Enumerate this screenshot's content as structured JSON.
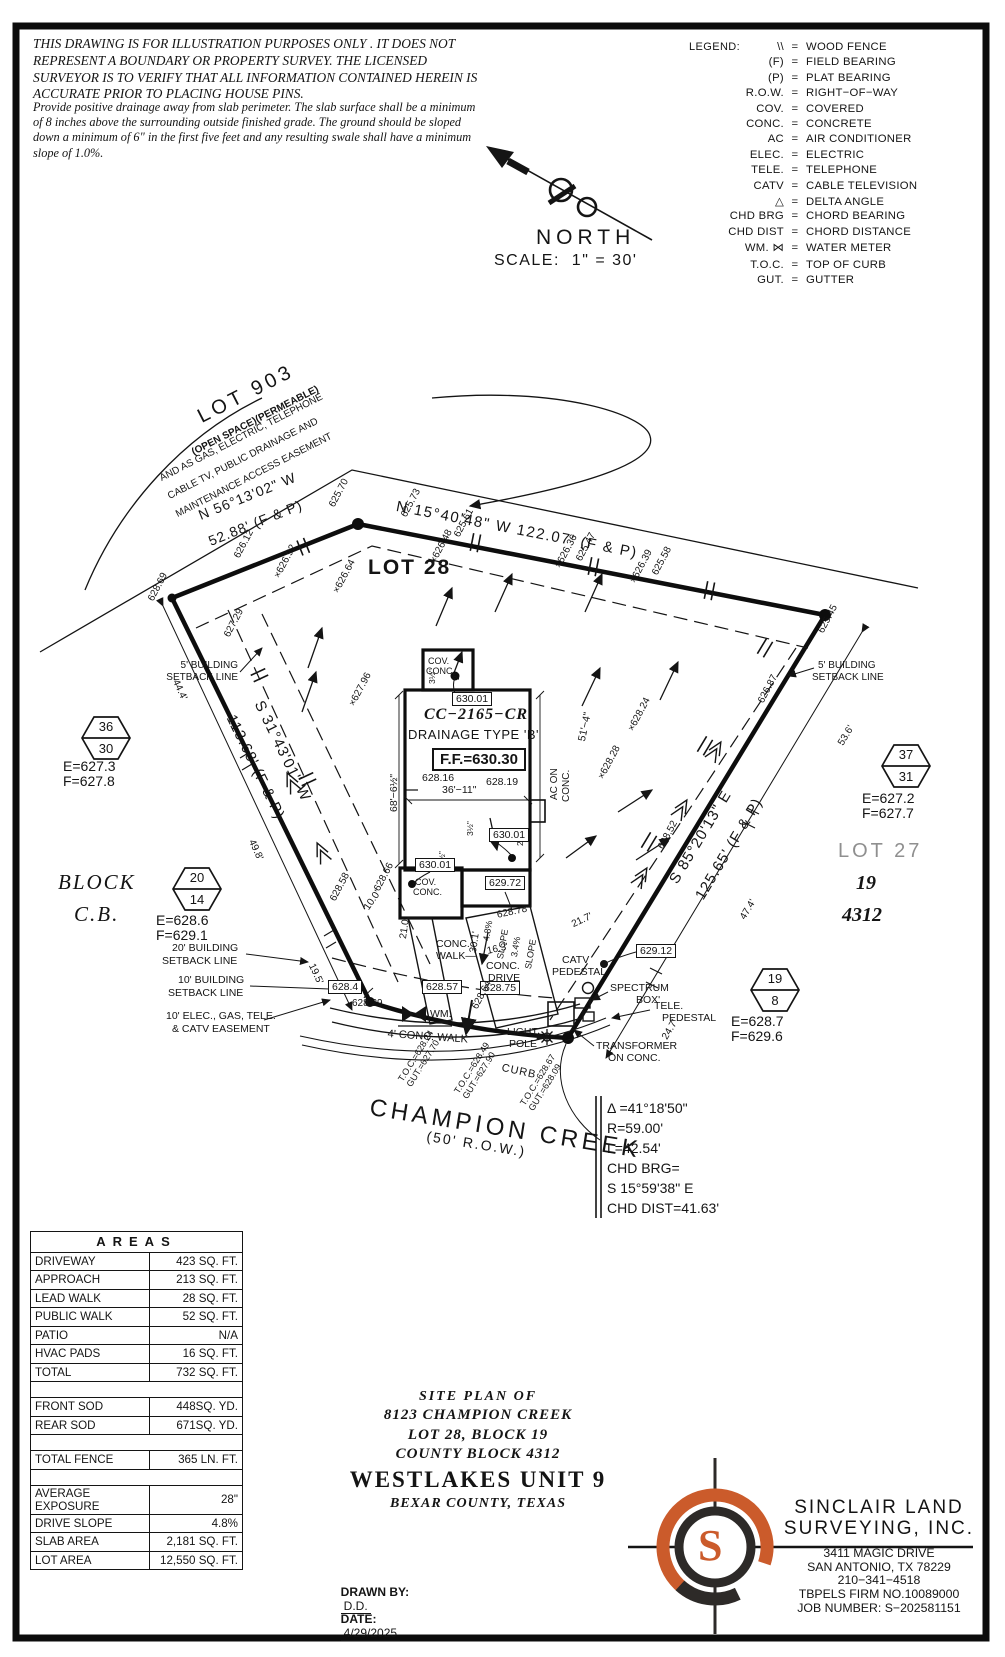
{
  "disclaimer": {
    "main": "THIS DRAWING IS FOR ILLUSTRATION PURPOSES ONLY . IT DOES NOT REPRESENT A BOUNDARY OR PROPERTY SURVEY. THE LICENSED SURVEYOR IS TO VERIFY THAT ALL INFORMATION CONTAINED HEREIN IS ACCURATE PRIOR TO PLACING HOUSE PINS.",
    "note": "Provide positive drainage away from slab perimeter. The slab surface shall be a minimum of 8 inches above the surrounding outside finished grade. The ground should be sloped down a minimum of 6\" in the first five feet and any resulting swale shall have a minimum slope of 1.0%."
  },
  "legend": {
    "title": "LEGEND:",
    "items": [
      {
        "sym": "\\\\",
        "def": "WOOD FENCE"
      },
      {
        "sym": "(F)",
        "def": "FIELD BEARING"
      },
      {
        "sym": "(P)",
        "def": "PLAT BEARING"
      },
      {
        "sym": "R.O.W.",
        "def": "RIGHT−OF−WAY"
      },
      {
        "sym": "COV.",
        "def": "COVERED"
      },
      {
        "sym": "CONC.",
        "def": "CONCRETE"
      },
      {
        "sym": "AC",
        "def": "AIR CONDITIONER"
      },
      {
        "sym": "ELEC.",
        "def": "ELECTRIC"
      },
      {
        "sym": "TELE.",
        "def": "TELEPHONE"
      },
      {
        "sym": "CATV",
        "def": "CABLE TELEVISION"
      },
      {
        "sym": "△",
        "def": "DELTA ANGLE"
      },
      {
        "sym": "CHD BRG",
        "def": "CHORD BEARING"
      },
      {
        "sym": "CHD DIST",
        "def": "CHORD DISTANCE"
      },
      {
        "sym": "WM. ⋈",
        "def": "WATER METER"
      },
      {
        "sym": "T.O.C.",
        "def": "TOP OF CURB"
      },
      {
        "sym": "GUT.",
        "def": "GUTTER"
      }
    ]
  },
  "compass": {
    "north": "NORTH",
    "scale": "SCALE:  1\" = 30'"
  },
  "adjacent": {
    "lot903": "LOT 903",
    "open": "(OPEN SPACE)(PERMEABLE)",
    "ease1": "AND AS GAS, ELECTRIC, TELEPHONE",
    "ease2": "CABLE TV, PUBLIC DRAINAGE AND",
    "ease3": "MAINTENANCE ACCESS EASEMENT"
  },
  "bearings": {
    "top": "N 15°40'48\" W 122.07' (F & P)",
    "nw1": "N 56°13'02\" W",
    "nw2": "52.88' (F & P)",
    "w1": "S 31°43'01\" W",
    "w2": "113.68' (F & P)",
    "e1": "S 85°20'13\" E",
    "e2": "125.65' (F & P)"
  },
  "lots": {
    "lot28": "LOT 28",
    "lot27": "LOT 27",
    "n19": "19",
    "n4312": "4312",
    "block": "BLOCK",
    "cb": "C.B."
  },
  "hex": [
    {
      "top": "36",
      "bottom": "30",
      "e": "E=627.3",
      "f": "F=627.8"
    },
    {
      "top": "20",
      "bottom": "14",
      "e": "E=628.6",
      "f": "F=629.1"
    },
    {
      "top": "37",
      "bottom": "31",
      "e": "E=627.2",
      "f": "F=627.7"
    },
    {
      "top": "19",
      "bottom": "8",
      "e": "E=628.7",
      "f": "F=629.6"
    }
  ],
  "setbacks": {
    "b5": "5' BUILDING",
    "b20": "20' BUILDING",
    "b10": "10' BUILDING",
    "line": "SETBACK LINE",
    "e10a": "10' ELEC., GAS, TELE.",
    "e10b": "& CATV EASEMENT"
  },
  "dims": {
    "d444": "44.4'",
    "d498": "49.8'",
    "d195": "19.5'",
    "d536": "53.6'",
    "d474": "47.4'",
    "d247": "24.7'",
    "d217": "21.7'",
    "d100": "10.0'",
    "d210": "21.0'",
    "d301": "30.1'",
    "d163": "16.3'",
    "w3611": "36'−11\"",
    "h6865": "68'−6½\"",
    "d514": "51'−4\"",
    "sl48": "4.8%",
    "sl34": "3.4%",
    "slope": "SLOPE"
  },
  "house": {
    "model": "CC−2165−CR",
    "drainage": "DRAINAGE TYPE 'B'",
    "ff": "F.F.=630.30",
    "e1": "628.16",
    "e2": "628.19",
    "cov1": "COV.",
    "cov2": "CONC.",
    "ac1": "AC ON",
    "ac2": "CONC.",
    "t35": "3½\"",
    "t2in": "2\"",
    "t2ft": "2'"
  },
  "boxed": {
    "b63001": "630.01",
    "b62972": "629.72",
    "b62912": "629.12",
    "b6284": "628.4",
    "b62857": "628.57",
    "b62875": "628.75"
  },
  "spots": [
    "628.69",
    "625.70",
    "625.73",
    "625.61",
    "×626.48",
    "×626.36",
    "625.47",
    "×626.39",
    "625.58",
    "625.45",
    "626.12",
    "×626.92",
    "×626.64",
    "627.29",
    "×627.96",
    "626.87",
    "×628.24",
    "×628.28",
    "628.52",
    "628.58",
    "628.66",
    "628.29",
    "628.78",
    "628.64"
  ],
  "features": {
    "catv1": "CATV",
    "catv2": "PEDESTAL",
    "spec1": "SPECTRUM",
    "spec2": "BOX'",
    "tele1": "TELE.",
    "tele2": "PEDESTAL",
    "tr1": "TRANSFORMER",
    "tr2": "ON CONC.",
    "lp1": "LIGHT",
    "lp2": "POLE",
    "wm": "WM.",
    "walk4": "4' CONC. WALK",
    "cw1": "CONC.",
    "cw2": "WALK—",
    "cd1": "CONC.",
    "cd2": "DRIVE",
    "curb": "CURB"
  },
  "toc": [
    {
      "a": "T.O.C.=628.24",
      "b": "GUT.=627.70"
    },
    {
      "a": "T.O.C.=628.49",
      "b": "GUT.=627.90"
    },
    {
      "a": "T.O.C.=628.67",
      "b": "GUT.=628.09"
    }
  ],
  "street": {
    "name": "CHAMPION CREEK",
    "row": "(50' R.O.W.)"
  },
  "curve": {
    "l1": "Δ =41°18'50\"",
    "l2": "R=59.00'",
    "l3": "L=42.54'",
    "l4": "CHD BRG=",
    "l5": "S 15°59'38\" E",
    "l6": "CHD DIST=41.63'"
  },
  "areas": {
    "header": "AREAS",
    "rows": [
      {
        "label": "DRIVEWAY",
        "value": "423 SQ. FT."
      },
      {
        "label": "APPROACH",
        "value": "213 SQ. FT."
      },
      {
        "label": "LEAD WALK",
        "value": "28 SQ. FT."
      },
      {
        "label": "PUBLIC WALK",
        "value": "52 SQ. FT."
      },
      {
        "label": "PATIO",
        "value": "N/A"
      },
      {
        "label": "HVAC PADS",
        "value": "16 SQ. FT."
      },
      {
        "label": "TOTAL",
        "value": "732 SQ. FT."
      },
      {
        "label": "",
        "value": ""
      },
      {
        "label": "FRONT SOD",
        "value": "448SQ. YD."
      },
      {
        "label": "REAR SOD",
        "value": "671SQ. YD."
      },
      {
        "label": "",
        "value": ""
      },
      {
        "label": "TOTAL FENCE",
        "value": "365 LN. FT."
      },
      {
        "label": "",
        "value": ""
      },
      {
        "label": "AVERAGE EXPOSURE",
        "value": "28\""
      },
      {
        "label": "DRIVE SLOPE",
        "value": "4.8%"
      },
      {
        "label": "SLAB AREA",
        "value": "2,181 SQ. FT."
      },
      {
        "label": "LOT AREA",
        "value": "12,550 SQ. FT."
      }
    ]
  },
  "title_block": {
    "l1": "SITE PLAN OF",
    "l2": "8123 CHAMPION CREEK",
    "l3": "LOT 28, BLOCK 19",
    "l4": "COUNTY BLOCK 4312",
    "l5": "WESTLAKES UNIT 9",
    "l6": "BEXAR COUNTY, TEXAS",
    "drawn_label": "DRAWN BY:",
    "drawn": "D.D.",
    "date_label": "DATE:",
    "date": "4/29/2025"
  },
  "surveyor": {
    "name1": "SINCLAIR LAND",
    "name2": "SURVEYING, INC.",
    "addr1": "3411 MAGIC DRIVE",
    "addr2": "SAN ANTONIO, TX 78229",
    "addr3": "210−341−4518",
    "addr4": "TBPELS FIRM NO.10089000",
    "addr5": "JOB NUMBER: S−202581151",
    "logo_letter": "S",
    "colors": {
      "orange": "#cb5b2b",
      "dark": "#2d2a28"
    }
  }
}
